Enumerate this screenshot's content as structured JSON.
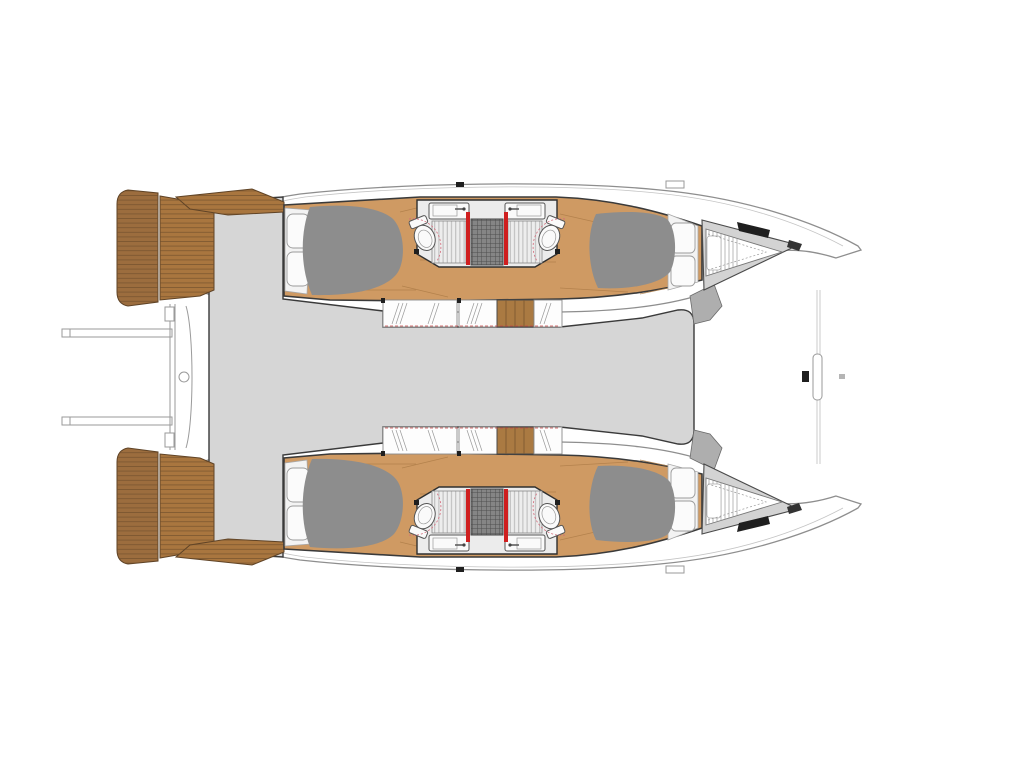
{
  "diagram": {
    "type": "catamaran-deck-floorplan",
    "orientation": "bow-right-stern-left",
    "visible_text": [],
    "colors": {
      "background": "#ffffff",
      "hull_outline": "#8e8e8e",
      "interior_outline": "#3a3a3a",
      "saloon_gray": "#d6d6d6",
      "bed_gray": "#8d8d8d",
      "wood_floor": "#cf9a63",
      "wood_plank_line": "#b07f4a",
      "teak_platform": "#9c6d3e",
      "teak_platform_light": "#a9763f",
      "teak_slat_line": "#6e4c2a",
      "teak_edge": "#5f4326",
      "stair_wood": "#aa7a42",
      "door_red": "#cf1f1f",
      "swing_arc_pink": "#d46a7a",
      "beam_gray": "#aeaeae",
      "bow_deck_gray": "#d3d3d3",
      "anchor_dark": "#1f1f1f",
      "shower_bg": "#ededed",
      "shower_stripe": "#b9b9b9",
      "grid_bg": "#858585",
      "grid_line": "#4f4f4f",
      "hatch_line": "#9a9a9a",
      "dashed_red": "#c84444",
      "fixture_stroke": "#555555"
    },
    "hulls": [
      {
        "name": "port-hull",
        "rooms": [
          "aft-double-cabin",
          "bathroom",
          "bathroom",
          "forward-double-cabin",
          "forepeak-locker"
        ]
      },
      {
        "name": "starboard-hull",
        "rooms": [
          "aft-double-cabin",
          "bathroom",
          "bathroom",
          "forward-double-cabin",
          "forepeak-locker"
        ]
      }
    ],
    "center_structures": [
      "aft-swim-platforms",
      "davit-arms",
      "cockpit",
      "saloon-deck",
      "forward-beam",
      "trampoline-area"
    ],
    "fixture_counts": {
      "double_beds": 4,
      "toilets": 4,
      "sinks": 4,
      "shower_floors": 4,
      "red_sliding_doors": 4,
      "companionway_stairs": 2,
      "swim_platforms": 2
    }
  }
}
